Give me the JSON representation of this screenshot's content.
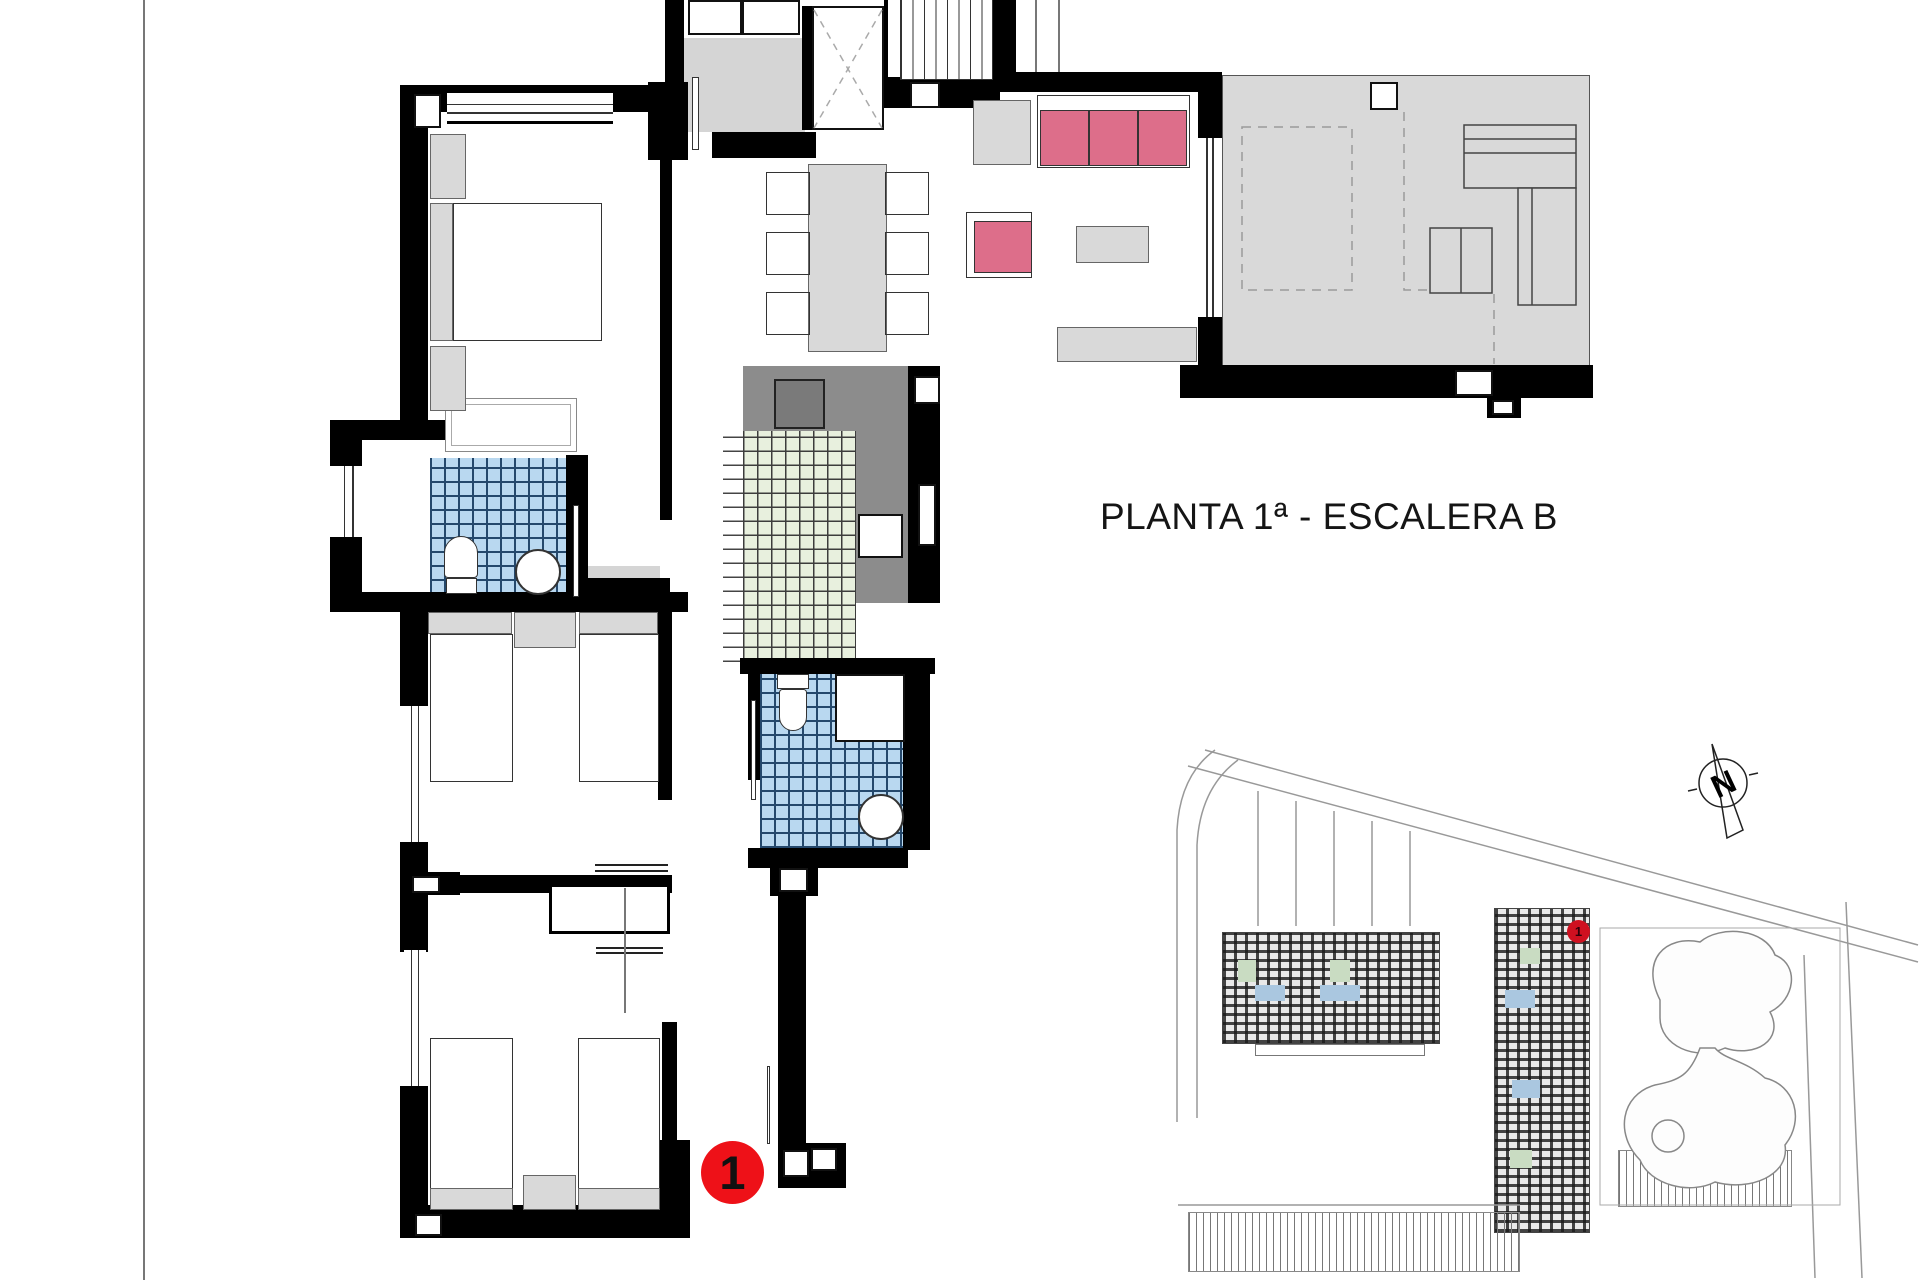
{
  "sheet": {
    "title": "PLANTA 1ª - ESCALERA B"
  },
  "floor_plan": {
    "unit_marker_label": "1"
  },
  "site_plan": {
    "unit_dot_label": "1",
    "compass_letter": "N"
  },
  "colors": {
    "marker_red": "#ee1118",
    "site_dot_red": "#cf1020",
    "sofa_pink": "#dd6e8a",
    "tile_blue": "#b9d8f0",
    "tile_blue_line": "#24486c",
    "tile_green": "#e8f0de",
    "tile_green_line": "#3c3c3c",
    "terrace_gray": "#d9d9d9",
    "counter_gray": "#8c8c8c",
    "wall_black": "#000000"
  }
}
